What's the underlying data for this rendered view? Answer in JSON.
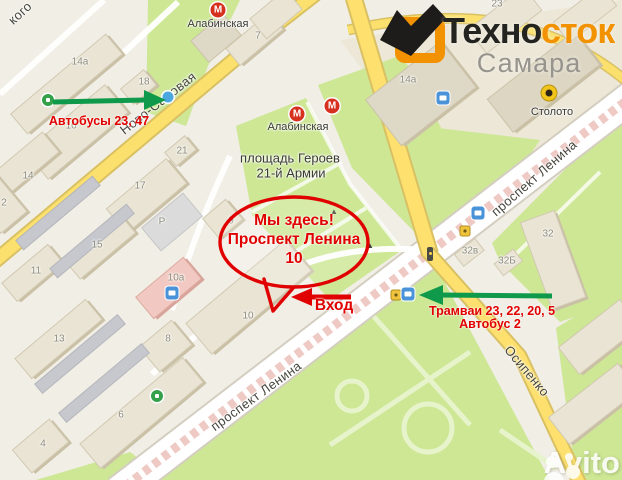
{
  "branding": {
    "logo_black": "Техно",
    "logo_orange_part": "сток",
    "city": "Самара",
    "watermark": "Avito",
    "orange": "#f39200"
  },
  "annotations": {
    "bus_left": "Автобусы 23, 47",
    "tram_right_line1": "Трамваи 23, 22, 20, 5",
    "tram_right_line2": "Автобус 2",
    "bubble_line1": "Мы здесь!",
    "bubble_line2": "Проспект Ленина",
    "bubble_line3": "10",
    "entrance": "Вход",
    "arrow_green": "#0e9a4a",
    "accent_red": "#e10000"
  },
  "map": {
    "palette": {
      "background": "#f1eee6",
      "park": "#cde795",
      "road_yellow": "#fbe06d",
      "building": "#e9e4d3",
      "tram_median": "#efc9c4",
      "metro_red": "#d6301f"
    },
    "street_labels": [
      {
        "t": "Ново-Садовая",
        "x": 158,
        "y": 103,
        "rot": -38
      },
      {
        "t": "проспект Ленина",
        "x": 534,
        "y": 178,
        "rot": -41
      },
      {
        "t": "проспект Ленина",
        "x": 256,
        "y": 396,
        "rot": -36
      },
      {
        "t": "Осипенко",
        "x": 527,
        "y": 371,
        "rot": 50
      },
      {
        "t": "кого",
        "x": 20,
        "y": 13,
        "rot": -43
      }
    ],
    "poi_labels": [
      {
        "t": "Алабинская",
        "x": 218,
        "y": 24
      },
      {
        "t": "Алабинская",
        "x": 298,
        "y": 127
      },
      {
        "t": "Столото",
        "x": 552,
        "y": 112
      },
      {
        "t": "площадь Героев",
        "x": 290,
        "y": 158,
        "size": 13
      },
      {
        "t": "21-й Армии",
        "x": 291,
        "y": 173,
        "size": 13
      }
    ],
    "building_numbers": [
      {
        "t": "7",
        "x": 258,
        "y": 36
      },
      {
        "t": "14а",
        "x": 80,
        "y": 62
      },
      {
        "t": "18",
        "x": 144,
        "y": 82
      },
      {
        "t": "16",
        "x": 71,
        "y": 126
      },
      {
        "t": "21",
        "x": 182,
        "y": 151
      },
      {
        "t": "14",
        "x": 28,
        "y": 176
      },
      {
        "t": "17",
        "x": 140,
        "y": 186
      },
      {
        "t": "15",
        "x": 97,
        "y": 245
      },
      {
        "t": "11",
        "x": 36,
        "y": 271
      },
      {
        "t": "10а",
        "x": 176,
        "y": 278
      },
      {
        "t": "2",
        "x": 4,
        "y": 203
      },
      {
        "t": "9",
        "x": 231,
        "y": 221
      },
      {
        "t": "10",
        "x": 248,
        "y": 316
      },
      {
        "t": "13",
        "x": 59,
        "y": 339
      },
      {
        "t": "8",
        "x": 168,
        "y": 339
      },
      {
        "t": "6",
        "x": 121,
        "y": 415
      },
      {
        "t": "4",
        "x": 43,
        "y": 444
      },
      {
        "t": "14а",
        "x": 408,
        "y": 80
      },
      {
        "t": "32",
        "x": 548,
        "y": 234
      },
      {
        "t": "32в",
        "x": 470,
        "y": 251
      },
      {
        "t": "32Б",
        "x": 507,
        "y": 261
      },
      {
        "t": "23",
        "x": 497,
        "y": 4
      },
      {
        "t": "Р",
        "x": 162,
        "y": 222
      }
    ],
    "icons": [
      {
        "type": "metro",
        "x": 218,
        "y": 10
      },
      {
        "type": "metro",
        "x": 297,
        "y": 114
      },
      {
        "type": "metro",
        "x": 332,
        "y": 106
      },
      {
        "type": "lottery",
        "x": 549,
        "y": 93
      },
      {
        "type": "bank",
        "x": 48,
        "y": 100
      },
      {
        "type": "bank",
        "x": 157,
        "y": 396
      },
      {
        "type": "clinic",
        "x": 168,
        "y": 97
      },
      {
        "type": "shop",
        "x": 172,
        "y": 293
      },
      {
        "type": "cinema",
        "x": 443,
        "y": 98
      },
      {
        "type": "bus-blue",
        "x": 478,
        "y": 213
      },
      {
        "type": "bus-yellow",
        "x": 465,
        "y": 231
      },
      {
        "type": "traffic-light",
        "x": 430,
        "y": 254
      },
      {
        "type": "bus-yellow",
        "x": 396,
        "y": 295
      },
      {
        "type": "tram-stop",
        "x": 408,
        "y": 294
      },
      {
        "type": "monument",
        "x": 334,
        "y": 212
      },
      {
        "type": "monument",
        "x": 370,
        "y": 246
      }
    ],
    "icon_glyphs": {
      "metro": "М",
      "monument": "▲"
    }
  }
}
